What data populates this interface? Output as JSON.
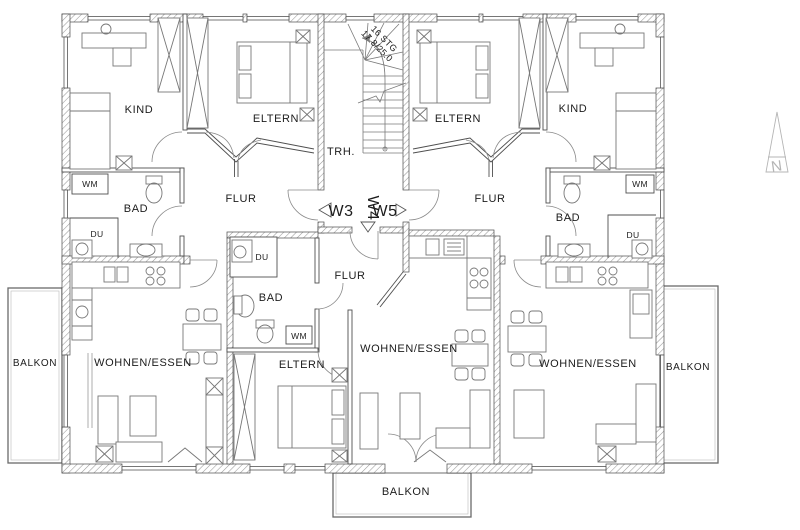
{
  "plan": {
    "type": "apartment-floor-plan",
    "colors": {
      "ink": "#4a4a4a",
      "hatch": "#999999",
      "furniture": "#777777",
      "text": "#1c1c1c",
      "north_arrow": "#b5b5b5",
      "background": "#ffffff"
    },
    "units": {
      "w3": "W3",
      "w4": "W4",
      "w5": "W5"
    },
    "stairwell": {
      "label": "TRH.",
      "note_line1": "16 STG",
      "note_line2": "17.8/25.0"
    },
    "north": {
      "label": "N"
    },
    "rooms": {
      "kind_left": "KIND",
      "eltern_left": "ELTERN",
      "flur_left": "FLUR",
      "bad_left": "BAD",
      "wm_left": "WM",
      "du_left": "DU",
      "eltern_right": "ELTERN",
      "kind_right": "KIND",
      "flur_right": "FLUR",
      "bad_right": "BAD",
      "wm_right": "WM",
      "du_right": "DU",
      "wohnen_left": "WOHNEN/ESSEN",
      "du_mid": "DU",
      "bad_mid": "BAD",
      "wm_mid": "WM",
      "flur_mid": "FLUR",
      "eltern_mid": "ELTERN",
      "wohnen_mid": "WOHNEN/ESSEN",
      "wohnen_right": "WOHNEN/ESSEN",
      "balkon_left": "BALKON",
      "balkon_right": "BALKON",
      "balkon_bottom": "BALKON"
    }
  }
}
